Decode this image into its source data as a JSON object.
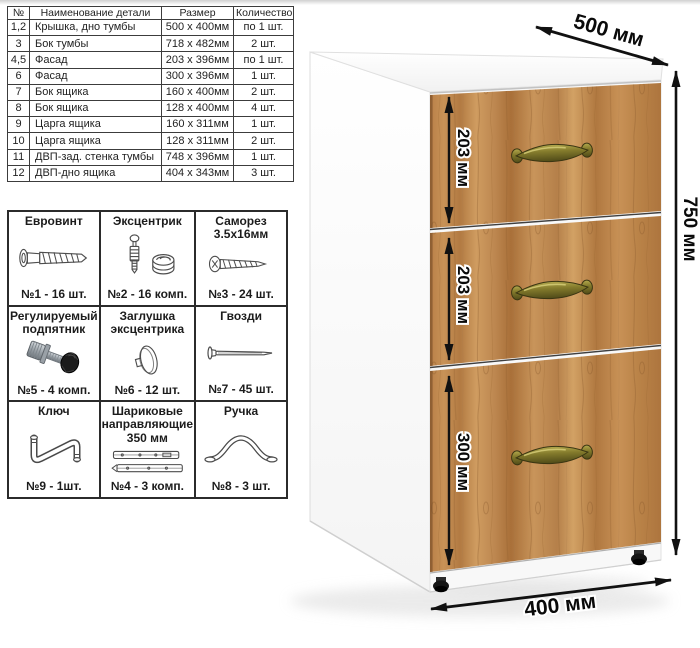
{
  "parts_table": {
    "headers": [
      "№",
      "Наименование детали",
      "Размер",
      "Количество"
    ],
    "rows": [
      [
        "1,2",
        "Крышка, дно тумбы",
        "500 х 400мм",
        "по 1 шт."
      ],
      [
        "3",
        "Бок тумбы",
        "718 х 482мм",
        "2 шт."
      ],
      [
        "4,5",
        "Фасад",
        "203 х 396мм",
        "по 1 шт."
      ],
      [
        "6",
        "Фасад",
        "300 х 396мм",
        "1 шт."
      ],
      [
        "7",
        "Бок ящика",
        "160 х 400мм",
        "2 шт."
      ],
      [
        "8",
        "Бок ящика",
        "128 х 400мм",
        "4 шт."
      ],
      [
        "9",
        "Царга ящика",
        "160 х 311мм",
        "1 шт."
      ],
      [
        "10",
        "Царга ящика",
        "128 х 311мм",
        "2 шт."
      ],
      [
        "11",
        "ДВП-зад. стенка тумбы",
        "748 х 396мм",
        "1 шт."
      ],
      [
        "12",
        "ДВП-дно ящика",
        "404 х 343мм",
        "3 шт."
      ]
    ]
  },
  "hardware": {
    "items": [
      {
        "title": "Евровинт",
        "qty": "№1 - 16 шт.",
        "icon": "euroscrew-icon"
      },
      {
        "title": "Эксцентрик",
        "qty": "№2 - 16 комп.",
        "icon": "eccentric-cam-icon"
      },
      {
        "title": "Саморез 3.5х16мм",
        "qty": "№3 - 24 шт.",
        "icon": "screw-icon"
      },
      {
        "title": "Регулируемый подпятник",
        "qty": "№5 - 4 комп.",
        "icon": "adjustable-foot-icon"
      },
      {
        "title": "Заглушка эксцентрика",
        "qty": "№6 - 12 шт.",
        "icon": "eccentric-cap-icon"
      },
      {
        "title": "Гвозди",
        "qty": "№7 - 45 шт.",
        "icon": "nail-icon"
      },
      {
        "title": "Ключ",
        "qty": "№9 - 1шт.",
        "icon": "hex-key-icon"
      },
      {
        "title": "Шариковые направляющие 350 мм",
        "qty": "№4 - 3 комп.",
        "icon": "ball-slides-icon"
      },
      {
        "title": "Ручка",
        "qty": "№8 - 3 шт.",
        "icon": "bow-handle-icon"
      }
    ]
  },
  "cabinet": {
    "depth_label": "500 мм",
    "height_label": "750 мм",
    "width_label": "400 мм",
    "drawer_labels": [
      "203 мм",
      "203 мм",
      "300 мм"
    ],
    "colors": {
      "wood": "#bd8750",
      "handle_brass": "#7c7427",
      "dimension_lines": "#111111",
      "carcass_white": "#fdfdfd"
    }
  }
}
